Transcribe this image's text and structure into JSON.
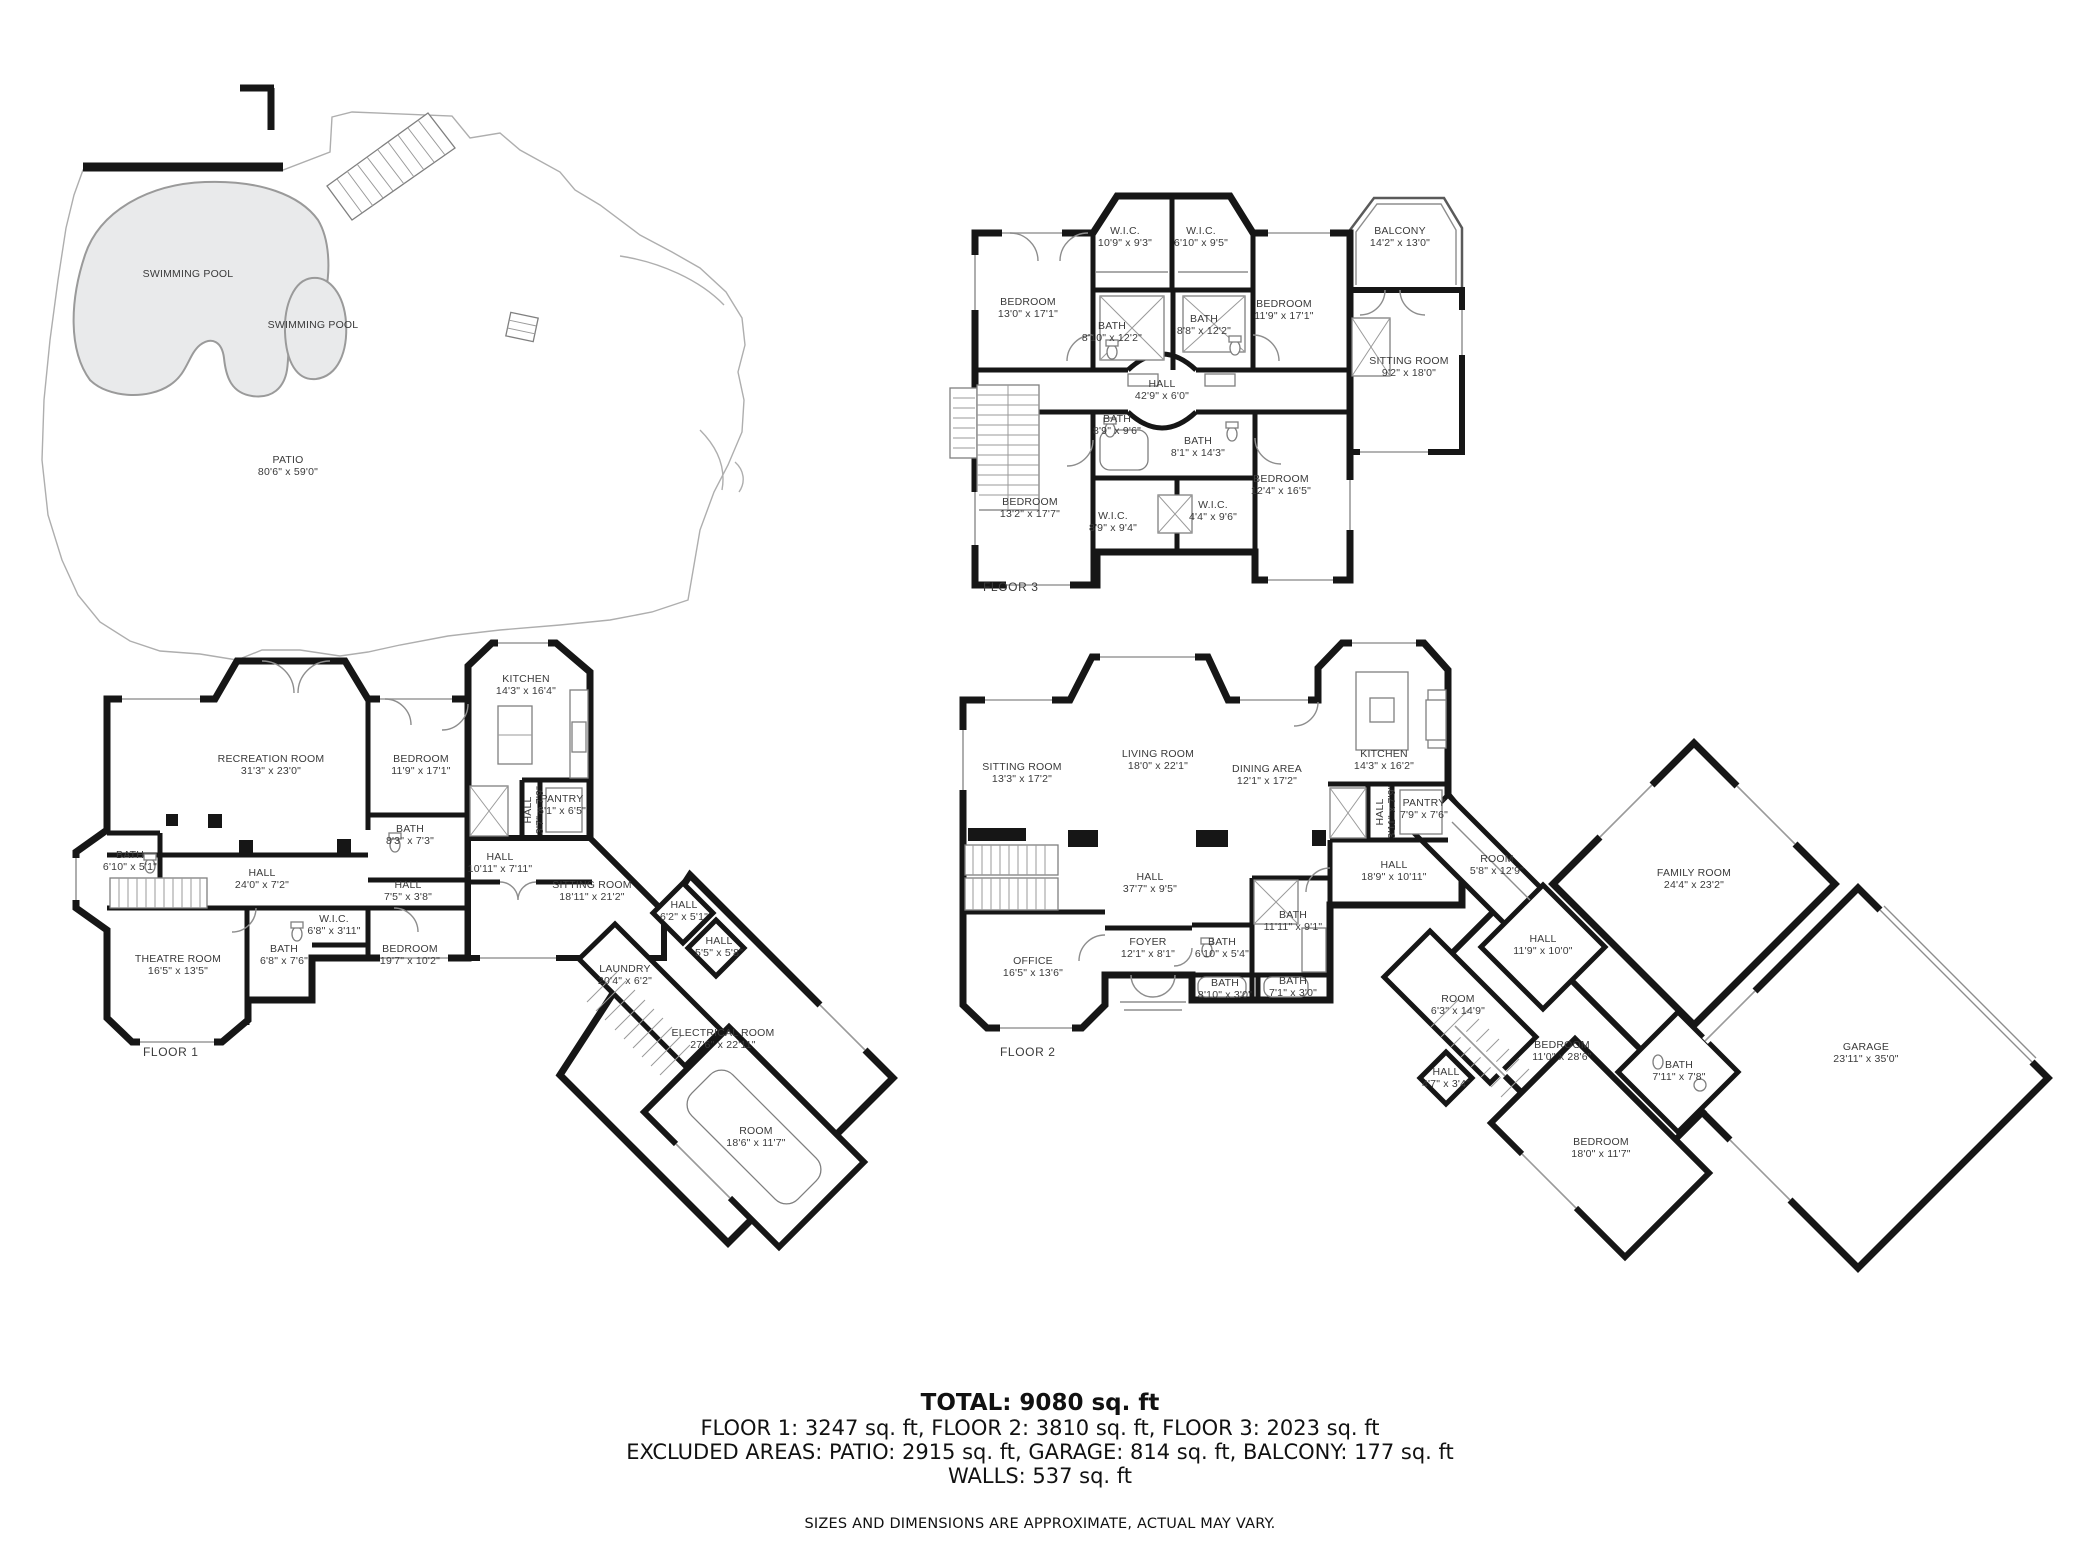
{
  "summary": {
    "total": "TOTAL: 9080 sq. ft",
    "floors": "FLOOR 1: 3247 sq. ft, FLOOR 2: 3810 sq. ft, FLOOR 3: 2023 sq. ft",
    "excluded": "EXCLUDED AREAS: PATIO: 2915 sq. ft, GARAGE: 814 sq. ft, BALCONY: 177 sq. ft",
    "walls": "WALLS: 537 sq. ft",
    "disclaimer": "SIZES AND DIMENSIONS ARE APPROXIMATE, ACTUAL MAY VARY."
  },
  "site": {
    "labels": [
      {
        "name": "SWIMMING POOL",
        "dims": "",
        "x": 188,
        "y": 277
      },
      {
        "name": "SWIMMING POOL",
        "dims": "",
        "x": 313,
        "y": 328
      },
      {
        "name": "PATIO",
        "dims": "80'6\" x 59'0\"",
        "x": 288,
        "y": 463
      }
    ]
  },
  "floor_plans": [
    {
      "id": "floor3",
      "caption": "FLOOR 3",
      "caption_x": 983,
      "caption_y": 591,
      "rooms": [
        {
          "name": "W.I.C.",
          "dims": "10'9\" x 9'3\"",
          "x": 1125,
          "y": 234
        },
        {
          "name": "W.I.C.",
          "dims": "6'10\" x 9'5\"",
          "x": 1201,
          "y": 234
        },
        {
          "name": "BEDROOM",
          "dims": "13'0\" x 17'1\"",
          "x": 1028,
          "y": 305
        },
        {
          "name": "BEDROOM",
          "dims": "11'9\" x 17'1\"",
          "x": 1284,
          "y": 307
        },
        {
          "name": "BATH",
          "dims": "8'10\" x 12'2\"",
          "x": 1112,
          "y": 329
        },
        {
          "name": "BATH",
          "dims": "8'8\" x 12'2\"",
          "x": 1204,
          "y": 322
        },
        {
          "name": "HALL",
          "dims": "42'9\" x 6'0\"",
          "x": 1162,
          "y": 387
        },
        {
          "name": "BATH",
          "dims": "8'9\" x 9'6\"",
          "x": 1117,
          "y": 422
        },
        {
          "name": "BATH",
          "dims": "8'1\" x 14'3\"",
          "x": 1198,
          "y": 444
        },
        {
          "name": "BEDROOM",
          "dims": "13'2\" x 17'7\"",
          "x": 1030,
          "y": 505
        },
        {
          "name": "BEDROOM",
          "dims": "12'4\" x 16'5\"",
          "x": 1281,
          "y": 482
        },
        {
          "name": "W.I.C.",
          "dims": "8'9\" x 9'4\"",
          "x": 1113,
          "y": 519
        },
        {
          "name": "W.I.C.",
          "dims": "4'4\" x 9'6\"",
          "x": 1213,
          "y": 508
        },
        {
          "name": "BALCONY",
          "dims": "14'2\" x 13'0\"",
          "x": 1400,
          "y": 234
        },
        {
          "name": "SITTING ROOM",
          "dims": "9'2\" x 18'0\"",
          "x": 1409,
          "y": 364
        }
      ]
    },
    {
      "id": "floor1",
      "caption": "FLOOR 1",
      "caption_x": 143,
      "caption_y": 1056,
      "rooms": [
        {
          "name": "RECREATION ROOM",
          "dims": "31'3\" x 23'0\"",
          "x": 271,
          "y": 762
        },
        {
          "name": "BEDROOM",
          "dims": "11'9\" x 17'1\"",
          "x": 421,
          "y": 762
        },
        {
          "name": "KITCHEN",
          "dims": "14'3\" x 16'4\"",
          "x": 526,
          "y": 682
        },
        {
          "name": "BATH",
          "dims": "6'10\" x 5'1\"",
          "x": 130,
          "y": 858
        },
        {
          "name": "BATH",
          "dims": "8'3\" x 7'3\"",
          "x": 410,
          "y": 832
        },
        {
          "name": "HALL",
          "dims": "24'0\" x 7'2\"",
          "x": 262,
          "y": 876
        },
        {
          "name": "HALL",
          "dims": "7'5\" x 3'8\"",
          "x": 408,
          "y": 888
        },
        {
          "name": "HALL",
          "dims": "10'11\" x 7'11\"",
          "x": 500,
          "y": 860
        },
        {
          "name": "PANTRY",
          "dims": "5'1\" x 6'5\"",
          "x": 562,
          "y": 802
        },
        {
          "name": "HALL",
          "dims": "3'7\" x 7'9\"",
          "x": 531,
          "y": 810,
          "rot": -90
        },
        {
          "name": "W.I.C.",
          "dims": "6'8\" x 3'11\"",
          "x": 334,
          "y": 922
        },
        {
          "name": "BATH",
          "dims": "6'8\" x 7'6\"",
          "x": 284,
          "y": 952
        },
        {
          "name": "BEDROOM",
          "dims": "19'7\" x 10'2\"",
          "x": 410,
          "y": 952
        },
        {
          "name": "THEATRE ROOM",
          "dims": "16'5\" x 13'5\"",
          "x": 178,
          "y": 962
        },
        {
          "name": "SITTING ROOM",
          "dims": "18'11\" x 21'2\"",
          "x": 592,
          "y": 888
        },
        {
          "name": "HALL",
          "dims": "6'2\" x 5'1\"",
          "x": 684,
          "y": 908
        },
        {
          "name": "HALL",
          "dims": "5'5\" x 5'8\"",
          "x": 719,
          "y": 944
        },
        {
          "name": "LAUNDRY",
          "dims": "20'4\" x 6'2\"",
          "x": 625,
          "y": 972
        },
        {
          "name": "ELECTRICAL ROOM",
          "dims": "27'6\" x 22'11\"",
          "x": 723,
          "y": 1036
        },
        {
          "name": "ROOM",
          "dims": "18'6\" x 11'7\"",
          "x": 756,
          "y": 1134
        }
      ]
    },
    {
      "id": "floor2",
      "caption": "FLOOR 2",
      "caption_x": 1000,
      "caption_y": 1056,
      "rooms": [
        {
          "name": "SITTING ROOM",
          "dims": "13'3\" x 17'2\"",
          "x": 1022,
          "y": 770
        },
        {
          "name": "LIVING ROOM",
          "dims": "18'0\" x 22'1\"",
          "x": 1158,
          "y": 757
        },
        {
          "name": "DINING AREA",
          "dims": "12'1\" x 17'2\"",
          "x": 1267,
          "y": 772
        },
        {
          "name": "KITCHEN",
          "dims": "14'3\" x 16'2\"",
          "x": 1384,
          "y": 757
        },
        {
          "name": "HALL",
          "dims": "37'7\" x 9'5\"",
          "x": 1150,
          "y": 880
        },
        {
          "name": "PANTRY",
          "dims": "7'9\" x 7'6\"",
          "x": 1424,
          "y": 806
        },
        {
          "name": "HALL",
          "dims": "3'11\" x 7'9\"",
          "x": 1383,
          "y": 812,
          "rot": -90
        },
        {
          "name": "HALL",
          "dims": "18'9\" x 10'11\"",
          "x": 1394,
          "y": 868
        },
        {
          "name": "ROOM",
          "dims": "5'8\" x 12'9\"",
          "x": 1497,
          "y": 862
        },
        {
          "name": "BATH",
          "dims": "11'11\" x 9'1\"",
          "x": 1293,
          "y": 918
        },
        {
          "name": "FOYER",
          "dims": "12'1\" x 8'1\"",
          "x": 1148,
          "y": 945
        },
        {
          "name": "BATH",
          "dims": "6'10\" x 5'4\"",
          "x": 1222,
          "y": 945
        },
        {
          "name": "BATH",
          "dims": "8'10\" x 3'0\"",
          "x": 1225,
          "y": 986
        },
        {
          "name": "BATH",
          "dims": "7'1\" x 3'0\"",
          "x": 1293,
          "y": 984
        },
        {
          "name": "OFFICE",
          "dims": "16'5\" x 13'6\"",
          "x": 1033,
          "y": 964
        },
        {
          "name": "FAMILY ROOM",
          "dims": "24'4\" x 23'2\"",
          "x": 1694,
          "y": 876
        },
        {
          "name": "GARAGE",
          "dims": "23'11\" x 35'0\"",
          "x": 1866,
          "y": 1050
        },
        {
          "name": "HALL",
          "dims": "11'9\" x 10'0\"",
          "x": 1543,
          "y": 942
        },
        {
          "name": "ROOM",
          "dims": "6'3\" x 14'9\"",
          "x": 1458,
          "y": 1002
        },
        {
          "name": "BEDROOM",
          "dims": "11'0\" x 28'6\"",
          "x": 1562,
          "y": 1048
        },
        {
          "name": "HALL",
          "dims": "4'7\" x 3'4\"",
          "x": 1446,
          "y": 1075
        },
        {
          "name": "BATH",
          "dims": "7'11\" x 7'8\"",
          "x": 1679,
          "y": 1068
        },
        {
          "name": "BEDROOM",
          "dims": "18'0\" x 11'7\"",
          "x": 1601,
          "y": 1145
        }
      ]
    }
  ]
}
